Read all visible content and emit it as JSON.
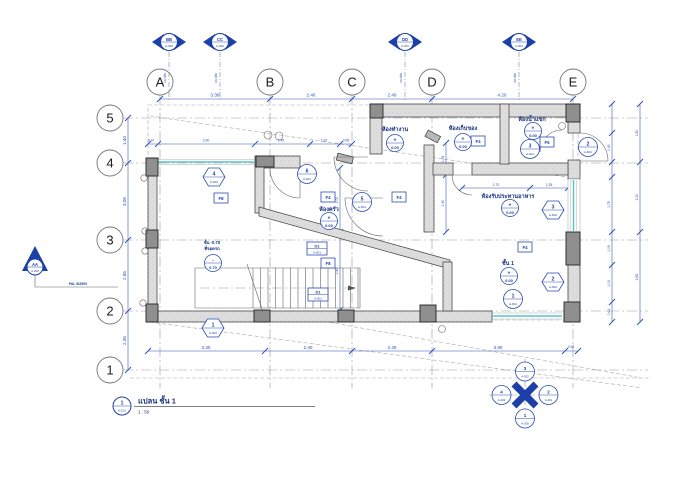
{
  "title_block": {
    "number": "1",
    "sheet": "A-101",
    "title": "แปลน ชั้น 1",
    "scale": "1 : 50"
  },
  "grids": {
    "letters": [
      "A",
      "B",
      "C",
      "D",
      "E"
    ],
    "numbers": [
      "5",
      "4",
      "3",
      "2",
      "1"
    ]
  },
  "dims": {
    "top": [
      "3.30",
      "2.40",
      "2.40",
      "4.20"
    ],
    "top2": [
      "0.10",
      "2.90",
      "0.45",
      "1.02",
      "0.55"
    ],
    "left": [
      "1.40",
      "3.05",
      "2.85",
      "2.35"
    ],
    "bottom": [
      "3.30",
      "2.40",
      "2.40",
      "3.90",
      "0.38"
    ],
    "right_inner": [
      "0.90",
      "1.75",
      "1.05",
      "1.15",
      "0.63"
    ],
    "right_outer": [
      "1.80",
      "2.20",
      "2.85"
    ],
    "stair_v": [
      "2.00",
      "2.45"
    ],
    "mid_v": [
      "1.06",
      "1.90"
    ],
    "dining_h": [
      "1.70",
      "1.28"
    ]
  },
  "rooms": {
    "kitchen": {
      "name": "ห้องครัว",
      "sign": "+",
      "level": "0.00"
    },
    "office": {
      "name": "ห้องทำงาน",
      "sign": "+",
      "level": "0.00"
    },
    "storage": {
      "name": "ห้องเก็บของ",
      "sign": "+",
      "level": "0.00"
    },
    "bath": {
      "name": "ห้องน้ำแขก",
      "sign": "+",
      "level": "0.00"
    },
    "dining": {
      "name": "ห้องรับประทานอาหาร",
      "sign": "+",
      "level": "0.00"
    },
    "hall": {
      "name": "ชั้น 1",
      "sign": "+",
      "level": "0.00"
    },
    "carport": {
      "name": "ชั้น -0.70",
      "name2": "ที่จอดรถ",
      "sign": "-",
      "level": "0.70"
    }
  },
  "door_tags": [
    {
      "num": "6",
      "sheet": "A-601"
    },
    {
      "num": "5",
      "sheet": "A-601"
    },
    {
      "num": "3",
      "sheet": "A-601"
    },
    {
      "num": "2",
      "sheet": "A-601"
    },
    {
      "num": "1",
      "sheet": "A-601"
    }
  ],
  "window_tags": [
    {
      "num": "4",
      "sheet": "A-602"
    },
    {
      "num": "3",
      "sheet": "A-602"
    },
    {
      "num": "2",
      "sheet": "A-602"
    },
    {
      "num": "1",
      "sheet": "A-602"
    }
  ],
  "floor_tags": [
    "F8",
    "F4",
    "F4",
    "F4",
    "F5",
    "F4",
    "F8"
  ],
  "detail_tags": [
    {
      "label": "D1",
      "sheet": "A-601"
    },
    {
      "label": "D1",
      "sheet": "A-601"
    }
  ],
  "sections": {
    "top": [
      {
        "label": "BB",
        "sheet": "A-300",
        "note": "แนวตัด"
      },
      {
        "label": "CC",
        "sheet": "A-300",
        "note": "แนวตัด"
      },
      {
        "label": "DD",
        "sheet": "A-300",
        "note": "แนวตัด"
      },
      {
        "label": "EE",
        "sheet": "A-300",
        "note": "แนวตัด"
      }
    ],
    "left": {
      "label": "AA",
      "sheet": "A-200",
      "note": "PAL W250X"
    },
    "compass": {
      "top": {
        "num": "3",
        "sheet": "A-202"
      },
      "right": {
        "num": "2",
        "sheet": "A-201"
      },
      "bottom": {
        "num": "1",
        "sheet": "A-200"
      },
      "left": {
        "num": "4",
        "sheet": "A-203"
      }
    }
  },
  "colors": {
    "annotation": "#2a4db5",
    "section": "#1c3fa8",
    "glass": "#5fc4c4"
  }
}
